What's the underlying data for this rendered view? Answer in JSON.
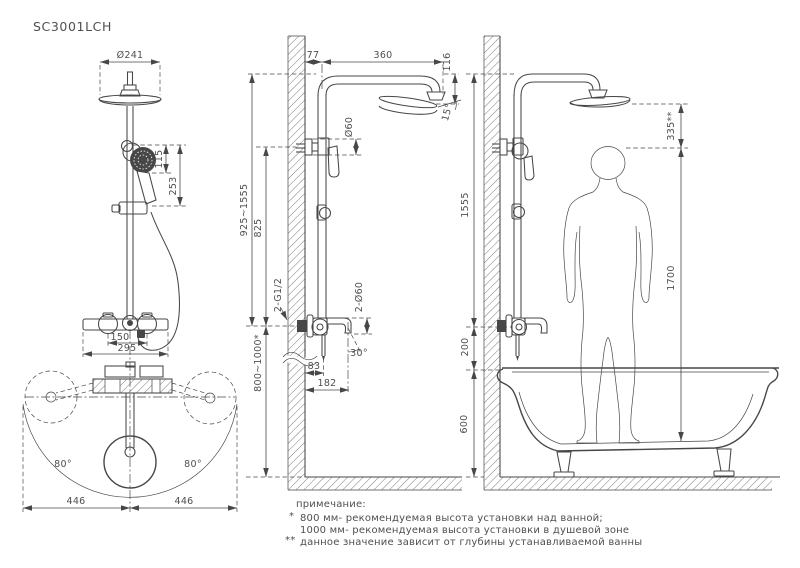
{
  "title": "SC3001LCH",
  "colors": {
    "line": "#474747",
    "text": "#4f4f4f",
    "background": "#ffffff"
  },
  "front_view": {
    "head_diameter": "Ø241",
    "handshower_face": "115",
    "handshower_length": "253",
    "supply_centers": "150",
    "body_width": "295",
    "plan": {
      "angle_left": "80°",
      "angle_right": "80°",
      "radius_left": "446",
      "radius_right": "446"
    }
  },
  "side_view": {
    "wall_offset": "77",
    "arm_reach": "360",
    "head_drop": "116",
    "head_tilt": "15°",
    "bracket_diameter": "Ø60",
    "column_range": "925~1555",
    "bracket_to_mixer": "825",
    "supply_thread": "2-G1/2",
    "escutcheon_diameter": "2-Ø60",
    "spout_angle": "30°",
    "spout_axis_offset": "83",
    "spout_reach": "182",
    "mixer_height": "800~1000*"
  },
  "installation_view": {
    "column_height": "1555",
    "head_clearance": "335**",
    "person_height": "1700",
    "mixer_above_tub": "200",
    "tub_height": "600"
  },
  "note": {
    "heading": "примечание:",
    "marker1": "*",
    "line1": "800 мм- рекомендуемая высота установки над ванной;",
    "line2": "1000 мм- рекомендуемая высота установки в душевой зоне",
    "marker2": "**",
    "line3": "данное значение зависит от глубины устанавливаемой ванны"
  }
}
